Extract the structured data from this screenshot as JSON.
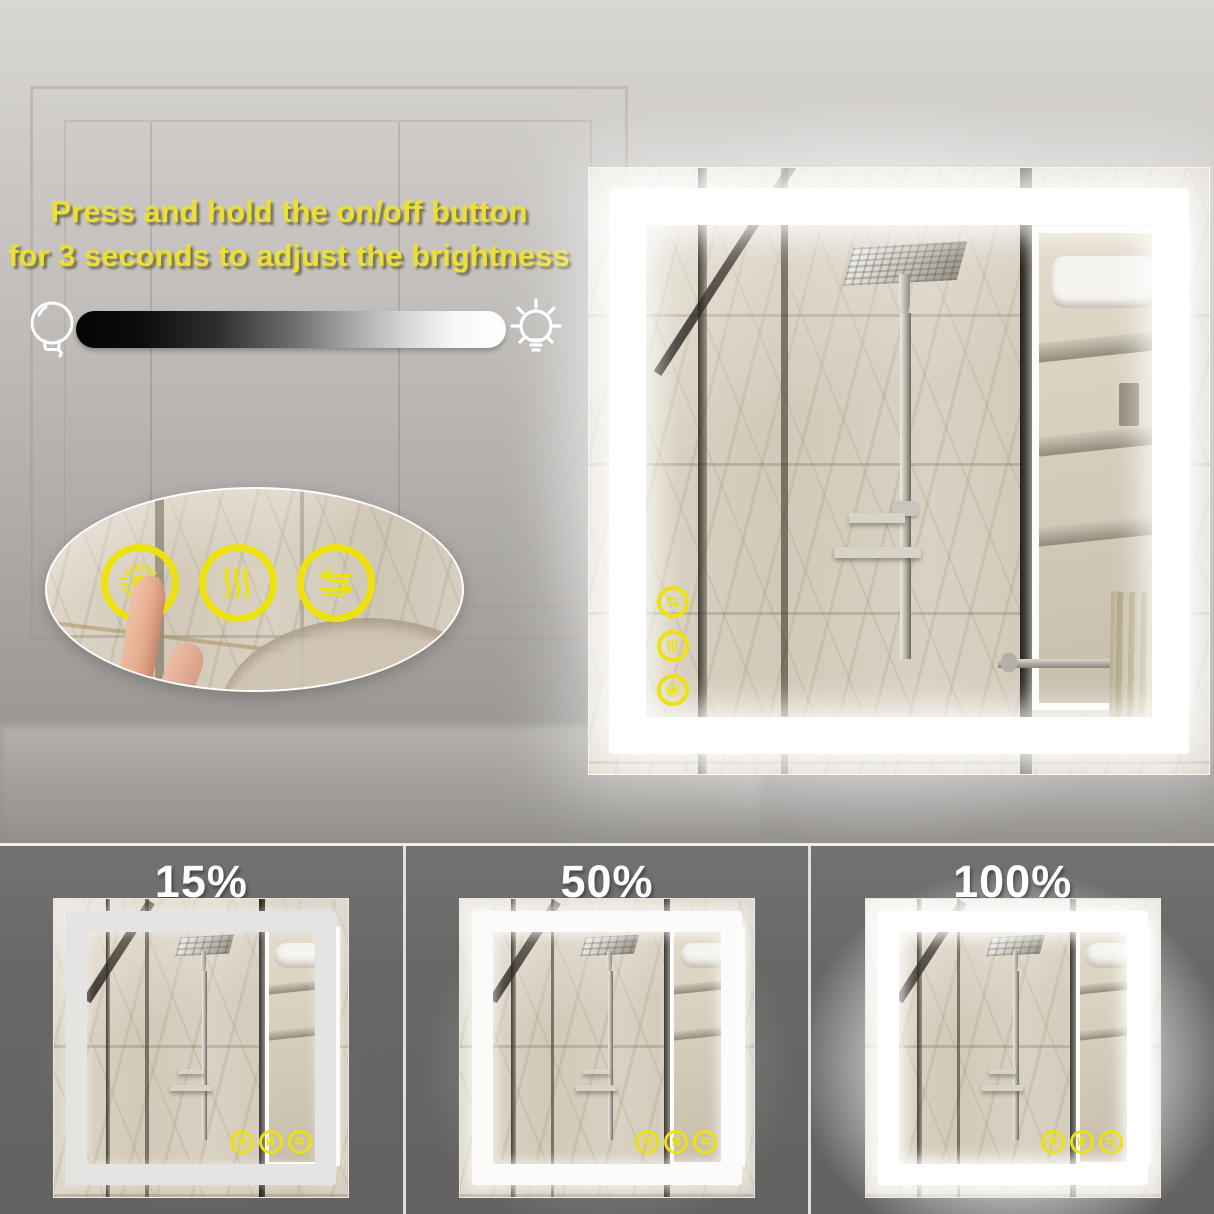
{
  "instruction": {
    "line1": "Press and hold the on/off button",
    "line2": "for 3 seconds to adjust the brightness"
  },
  "slider": {
    "min_icon": "bulb-off-icon",
    "max_icon": "bulb-on-icon",
    "gradient_start": "#000000",
    "gradient_end": "#ffffff"
  },
  "touch_buttons": [
    {
      "name": "brightness-button",
      "icon": "sun-icon"
    },
    {
      "name": "defog-button",
      "icon": "defog-icon"
    },
    {
      "name": "switch-button",
      "icon": "swap-arrows-icon"
    }
  ],
  "mirror_icons": [
    "swap-arrows-icon",
    "defog-icon",
    "sun-icon"
  ],
  "brightness_levels": [
    {
      "label": "15%"
    },
    {
      "label": "50%"
    },
    {
      "label": "100%"
    }
  ],
  "colors": {
    "accent_yellow": "#ecdf35",
    "icon_yellow": "#ede20e",
    "led_white": "#ffffff",
    "panel_gray": "#6b6a68"
  }
}
